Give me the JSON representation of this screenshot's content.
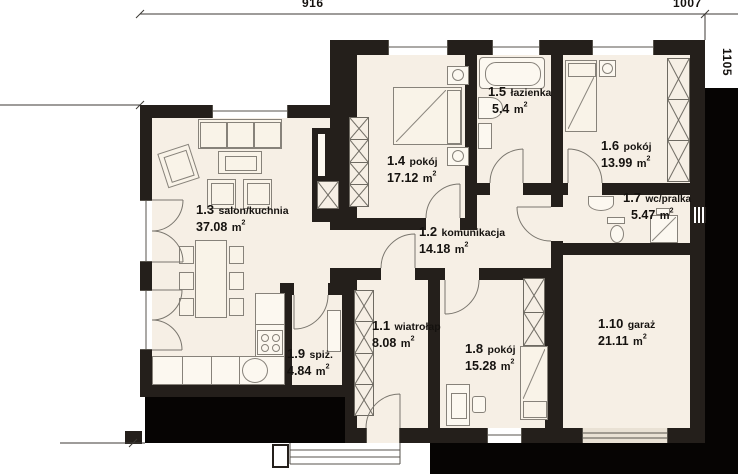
{
  "plan": {
    "title": "floor-plan",
    "area_unit": "m",
    "area_sup": "2",
    "rooms": [
      {
        "id": "1.1",
        "name": "wiatrołap",
        "area": "8.08"
      },
      {
        "id": "1.2",
        "name": "komunikacja",
        "area": "14.18"
      },
      {
        "id": "1.3",
        "name": "salon/kuchnia",
        "area": "37.08"
      },
      {
        "id": "1.4",
        "name": "pokój",
        "area": "17.12"
      },
      {
        "id": "1.5",
        "name": "łazienka",
        "area": "5.4"
      },
      {
        "id": "1.6",
        "name": "pokój",
        "area": "13.99"
      },
      {
        "id": "1.7",
        "name": "wc/pralka",
        "area": "5.47"
      },
      {
        "id": "1.8",
        "name": "pokój",
        "area": "15.28"
      },
      {
        "id": "1.9",
        "name": "spiż.",
        "area": "4.84"
      },
      {
        "id": "1.10",
        "name": "garaż",
        "area": "21.11"
      }
    ],
    "dimensions": {
      "top_left": "916",
      "top_right": "1007",
      "right_side": "1105"
    },
    "colors": {
      "wall": "#241f1b",
      "floor": "#f6efe5",
      "shadow": "#060403",
      "background": "#ffffff",
      "furniture_line": "#87827a"
    }
  }
}
